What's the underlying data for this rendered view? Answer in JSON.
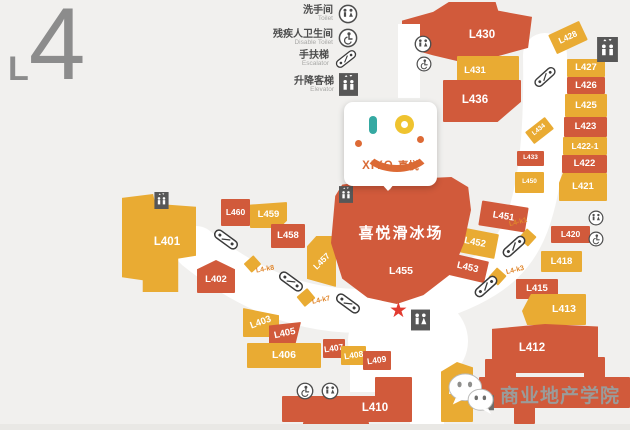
{
  "floor_label": {
    "prefix": "L",
    "number": "4"
  },
  "legend": {
    "items": [
      {
        "zh": "洗手间",
        "en": "Toilet"
      },
      {
        "zh": "残疾人卫生间",
        "en": "Disable Toilet"
      },
      {
        "zh": "手扶梯",
        "en": "Escalator"
      },
      {
        "zh": "升降客梯",
        "en": "Elevator"
      }
    ]
  },
  "logo": {
    "brand": "XIYO",
    "brand_zh": "喜悦"
  },
  "rink": {
    "name": "喜悦滑冰场",
    "unit": "L455"
  },
  "units": {
    "u401": "L401",
    "u402": "L402",
    "u403": "L403",
    "u405": "L405",
    "u406": "L406",
    "u407": "L407",
    "u408": "L408",
    "u409": "L409",
    "u410": "L410",
    "u411": "L411",
    "u412": "L412",
    "u413": "L413",
    "u415": "L415",
    "u418": "L418",
    "u420": "L420",
    "u421": "L421",
    "u422": "L422",
    "u422_1": "L422-1",
    "u423": "L423",
    "u425": "L425",
    "u426": "L426",
    "u427": "L427",
    "u428": "L428",
    "u430": "L430",
    "u431": "L431",
    "u433": "L433",
    "u434": "L434",
    "u436": "L436",
    "u450": "L450",
    "u451": "L451",
    "u452": "L452",
    "u453": "L453",
    "u457": "L457",
    "u458": "L458",
    "u459": "L459",
    "u460": "L460"
  },
  "kiosks": {
    "k1": "L4-k1",
    "k3": "L4-k3",
    "k7": "L4-k7",
    "k8": "L4-k8"
  },
  "icons": {
    "star": "★"
  },
  "colors": {
    "unit_red": "#d15a3b",
    "unit_yellow": "#e9ab33",
    "accent_orange": "#d96a35",
    "watermark_gray": "#9b9b99"
  },
  "watermark": {
    "text": "商业地产学院"
  }
}
